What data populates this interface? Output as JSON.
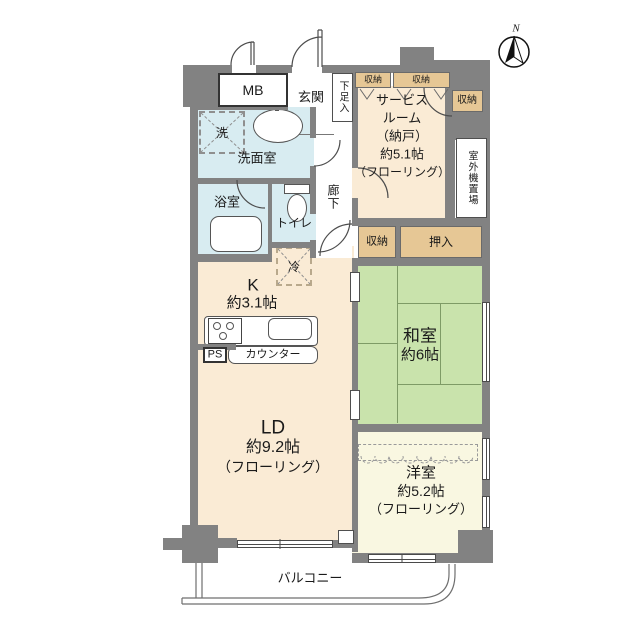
{
  "compass": {
    "north_label": "N"
  },
  "colors": {
    "wall_gray": "#828282",
    "room_cream": "#faebd5",
    "tatami_green": "#c9e3ac",
    "water_blue": "#d8ecf1",
    "closet_tan": "#e6c795",
    "western_pale": "#f9f7e1"
  },
  "rooms": {
    "meter_box": {
      "label": "MB"
    },
    "entrance": {
      "label": "玄関"
    },
    "shoe_cabinet": {
      "label": "下足入"
    },
    "washroom": {
      "label": "洗面室"
    },
    "laundry_machine": {
      "label": "洗"
    },
    "bathroom": {
      "label": "浴室"
    },
    "toilet": {
      "label": "トイレ"
    },
    "corridor": {
      "label": "廊下"
    },
    "service_room": {
      "lines": [
        "サービス",
        "ルーム",
        "（納戸）",
        "約5.1帖",
        "（フローリング）"
      ]
    },
    "storage_top_left": {
      "label": "収納"
    },
    "storage_top_right": {
      "label": "収納"
    },
    "storage_right": {
      "label": "収納"
    },
    "outdoor_unit_space": {
      "label": "室外機置場"
    },
    "storage_mid": {
      "label": "収納"
    },
    "oshiire": {
      "label": "押入"
    },
    "japanese_room": {
      "name": "和室",
      "size": "約6帖"
    },
    "kitchen": {
      "name": "K",
      "size": "約3.1帖"
    },
    "counter": {
      "label": "カウンター"
    },
    "pipe_space": {
      "label": "PS"
    },
    "refrigerator": {
      "label": "冷"
    },
    "living_dining": {
      "name": "LD",
      "size": "約9.2帖",
      "floor": "（フローリング）"
    },
    "western_room": {
      "name": "洋室",
      "size": "約5.2帖",
      "floor": "（フローリング）"
    },
    "balcony": {
      "label": "バルコニー"
    }
  }
}
